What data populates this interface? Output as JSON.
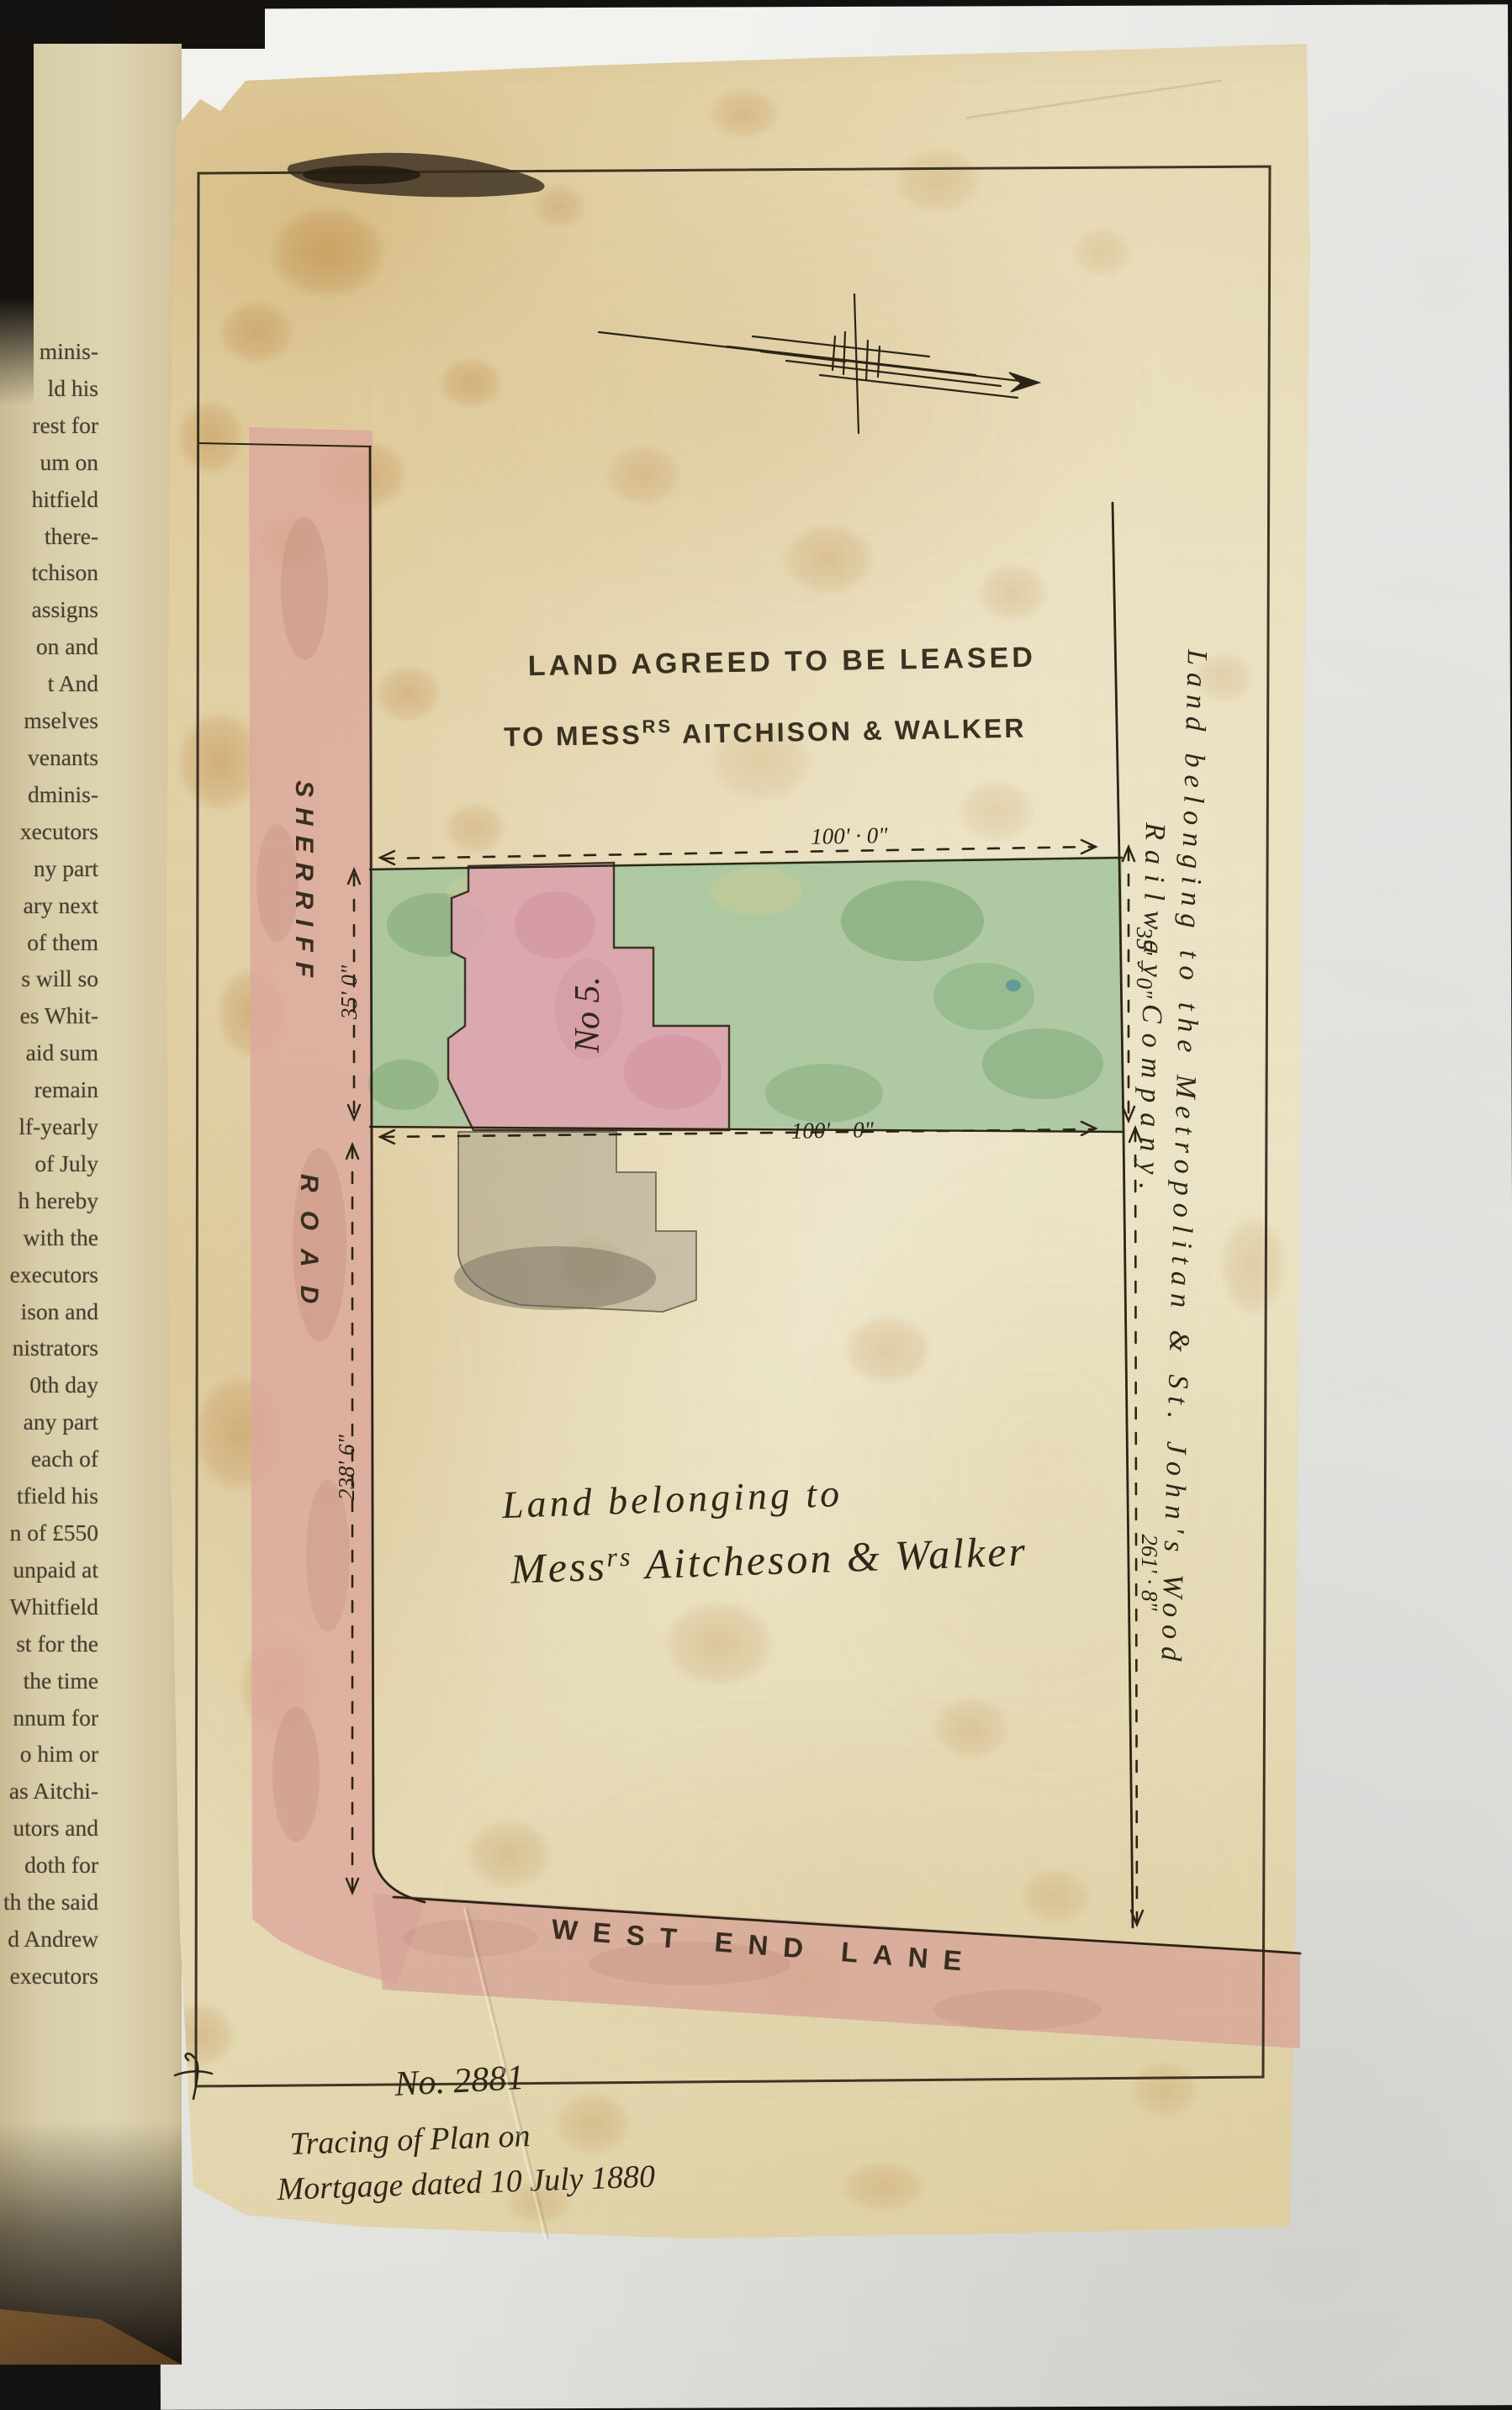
{
  "book_page": {
    "lines": [
      "minis-",
      "ld his",
      "rest for",
      "um on",
      "hitfield",
      "there-",
      "tchison",
      "assigns",
      "on and",
      "t And",
      "mselves",
      "venants",
      "dminis-",
      "xecutors",
      "ny part",
      "ary next",
      "of them",
      "s will so",
      "es Whit-",
      "aid sum",
      "remain",
      "lf-yearly",
      "of July",
      "h hereby",
      "with the",
      "executors",
      "ison and",
      "nistrators",
      "0th day",
      "any part",
      "each of",
      "tfield his",
      "n of £550",
      "unpaid at",
      "Whitfield",
      "st for the",
      "the time",
      "nnum for",
      "o him or",
      "as Aitchi-",
      "utors and",
      "doth for",
      "th the said",
      "d Andrew",
      "executors"
    ]
  },
  "plan": {
    "title": {
      "line1": "LAND AGREED TO BE LEASED",
      "line2_pre": "TO MESS",
      "line2_sup": "RS",
      "line2_post": " AITCHISON & WALKER"
    },
    "building_label": "No 5.",
    "roads": {
      "sherriff_word1": "SHERRIFF",
      "sherriff_word2": "ROAD",
      "west_end_lane": "WEST END LANE"
    },
    "dimensions": {
      "top_width": "100' · 0\"",
      "bottom_width": "100' – 0\"",
      "left_depth": "35' 0\"",
      "right_depth": "35' – 0\"",
      "sherriff_frontage": "238' 6\"",
      "railway_frontage": "261' · 8\""
    },
    "adjoining": {
      "railway_line1": "Land belonging to the Metropolitan & St. John's Wood",
      "railway_line2": "Railway Company.",
      "owner_line1": "Land belonging to",
      "owner_line2_pre": "Mess",
      "owner_line2_sup": "rs",
      "owner_line2_post": " Aitcheson & Walker"
    },
    "note": {
      "number": "No. 2881",
      "line1": "Tracing of Plan on",
      "line2": "Mortgage dated 10 July 1880"
    }
  },
  "colors": {
    "ink": "#2b2416",
    "green_parcel": "#a3c49c",
    "pink_road": "#dda89d",
    "pink_building": "#dfa5b0",
    "linen": "#e9dcb4",
    "book_paper": "#d9cda9",
    "backing_paper": "#ebebe8"
  }
}
